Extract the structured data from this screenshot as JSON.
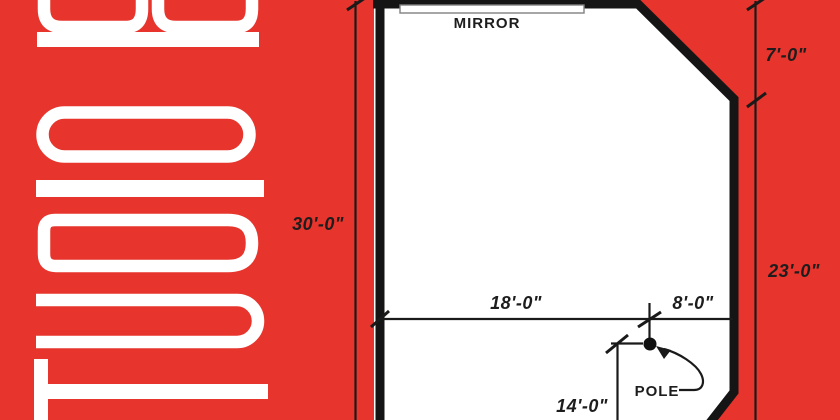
{
  "branding": {
    "vertical_text": "STUDIO B"
  },
  "floor_plan": {
    "labels": {
      "mirror": "MIRROR",
      "pole": "POLE"
    },
    "dimensions": {
      "wall_height_left": "30'-0\"",
      "chamfer_right_top": "7'-0\"",
      "wall_right_lower": "23'-0\"",
      "span_left_of_pole": "18'-0\"",
      "span_right_of_pole": "8'-0\"",
      "pole_to_bottom": "14'-0\""
    }
  },
  "colors": {
    "background": "#e7342c",
    "walls": "#151515",
    "floor": "#ffffff",
    "letters": "#ffffff",
    "dimension_text": "#1d1d1d"
  }
}
